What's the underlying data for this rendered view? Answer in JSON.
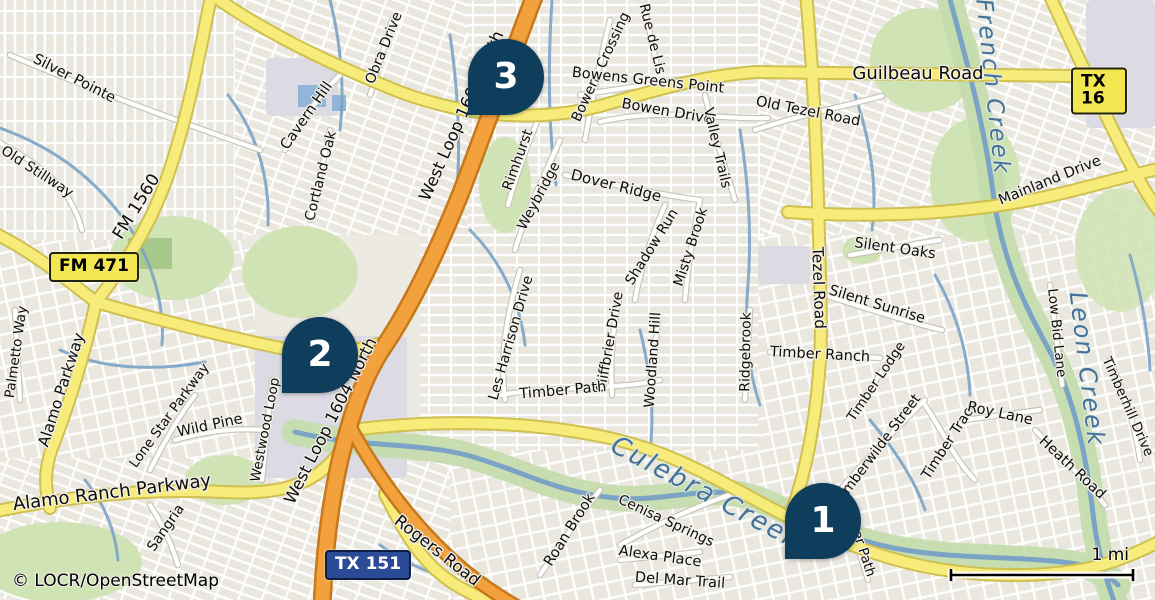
{
  "attribution": "© LOCR/OpenStreetMap",
  "scale": {
    "label": "1 mi"
  },
  "colors": {
    "marker": "#0f3e5d",
    "marker_text": "#ffffff",
    "water_label": "#44719c",
    "badge_yellow": "#f3e751",
    "badge_navy": "#2b4b96",
    "highway_orange": "#f2a13c",
    "road_yellow": "#f7ec7a",
    "creek_blue": "#7ba3c6",
    "park_green": "#cfe3b4"
  },
  "markers": [
    {
      "number": "1",
      "x": 823,
      "y": 521
    },
    {
      "number": "2",
      "x": 320,
      "y": 355
    },
    {
      "number": "3",
      "x": 506,
      "y": 77
    }
  ],
  "badges": [
    {
      "text": "FM 471",
      "x": 94,
      "y": 267,
      "style": "yellow"
    },
    {
      "text": "TX 151",
      "x": 368,
      "y": 565,
      "style": "navy"
    },
    {
      "text": "TX 16",
      "x": 1099,
      "y": 91,
      "style": "yellow"
    }
  ],
  "labels": [
    {
      "text": "Silver Pointe",
      "x": 74,
      "y": 79,
      "rot": 27,
      "size": 14.5
    },
    {
      "text": "Old Stillway",
      "x": 37,
      "y": 172,
      "rot": 33,
      "size": 14
    },
    {
      "text": "FM 1560",
      "x": 137,
      "y": 207,
      "rot": -58,
      "size": 17
    },
    {
      "text": "Palmetto Way",
      "x": 17,
      "y": 352,
      "rot": -82,
      "size": 13.5
    },
    {
      "text": "Alamo Parkway",
      "x": 62,
      "y": 390,
      "rot": -72,
      "size": 15.5
    },
    {
      "text": "Lone Star Parkway",
      "x": 170,
      "y": 416,
      "rot": -54,
      "size": 13.5
    },
    {
      "text": "Wild Pine",
      "x": 210,
      "y": 426,
      "rot": -12,
      "size": 14.5
    },
    {
      "text": "Alamo Ranch Parkway",
      "x": 112,
      "y": 493,
      "rot": -7,
      "size": 18
    },
    {
      "text": "Sangria",
      "x": 166,
      "y": 528,
      "rot": -55,
      "size": 14
    },
    {
      "text": "Westwood Loop",
      "x": 266,
      "y": 430,
      "rot": -79,
      "size": 13.5
    },
    {
      "text": "West Loop 1604 North",
      "x": 331,
      "y": 421,
      "rot": -63,
      "size": 16.5
    },
    {
      "text": "West Loop 1604 North",
      "x": 462,
      "y": 116,
      "rot": -66,
      "size": 16.5
    },
    {
      "text": "Rogers Road",
      "x": 437,
      "y": 551,
      "rot": 38,
      "size": 16.5
    },
    {
      "text": "Cavern Hill",
      "x": 307,
      "y": 116,
      "rot": -55,
      "size": 14.5
    },
    {
      "text": "Obra Drive",
      "x": 384,
      "y": 48,
      "rot": -68,
      "size": 14
    },
    {
      "text": "Cortland Oak",
      "x": 321,
      "y": 176,
      "rot": -76,
      "size": 14
    },
    {
      "text": "Rimhurst",
      "x": 518,
      "y": 160,
      "rot": -70,
      "size": 14
    },
    {
      "text": "Weybridge",
      "x": 539,
      "y": 196,
      "rot": -62,
      "size": 14
    },
    {
      "text": "Dover Ridge",
      "x": 616,
      "y": 186,
      "rot": 14,
      "size": 15
    },
    {
      "text": "Bowens Crossing",
      "x": 601,
      "y": 67,
      "rot": -65,
      "size": 14
    },
    {
      "text": "Rue de Lis",
      "x": 652,
      "y": 39,
      "rot": 76,
      "size": 14
    },
    {
      "text": "Bowens Greens Point",
      "x": 648,
      "y": 81,
      "rot": 6,
      "size": 14.5
    },
    {
      "text": "Bowen Drive",
      "x": 667,
      "y": 112,
      "rot": 10,
      "size": 14.5
    },
    {
      "text": "Valley Trails",
      "x": 717,
      "y": 148,
      "rot": 77,
      "size": 14
    },
    {
      "text": "Old Tezel Road",
      "x": 808,
      "y": 112,
      "rot": 11,
      "size": 14.5
    },
    {
      "text": "Guilbeau Road",
      "x": 918,
      "y": 74,
      "rot": 0,
      "size": 18
    },
    {
      "text": "Mainland Drive",
      "x": 1050,
      "y": 181,
      "rot": -22,
      "size": 14.5
    },
    {
      "text": "French Creek",
      "x": 992,
      "y": 87,
      "rot": 84,
      "size": 23,
      "kind": "water"
    },
    {
      "text": "Silent Oaks",
      "x": 895,
      "y": 249,
      "rot": 8,
      "size": 14.5
    },
    {
      "text": "Silent Sunrise",
      "x": 877,
      "y": 305,
      "rot": 17,
      "size": 14.5
    },
    {
      "text": "Tezel Road",
      "x": 818,
      "y": 288,
      "rot": 88,
      "size": 15.5
    },
    {
      "text": "Timber Ranch",
      "x": 820,
      "y": 355,
      "rot": 3,
      "size": 14.5
    },
    {
      "text": "Timber Lodge",
      "x": 877,
      "y": 382,
      "rot": -56,
      "size": 13.5
    },
    {
      "text": "Low Bid Lane",
      "x": 1056,
      "y": 333,
      "rot": 84,
      "size": 13.5
    },
    {
      "text": "Leon Creek",
      "x": 1087,
      "y": 369,
      "rot": 83,
      "size": 24,
      "kind": "water"
    },
    {
      "text": "Timberhill Drive",
      "x": 1127,
      "y": 407,
      "rot": 66,
      "size": 13.5
    },
    {
      "text": "Misty Brook",
      "x": 691,
      "y": 247,
      "rot": -72,
      "size": 14
    },
    {
      "text": "Shadow Run",
      "x": 652,
      "y": 247,
      "rot": -58,
      "size": 14
    },
    {
      "text": "Cliffbrier Drive",
      "x": 610,
      "y": 342,
      "rot": -80,
      "size": 14
    },
    {
      "text": "Woodland Hill",
      "x": 653,
      "y": 360,
      "rot": -86,
      "size": 14
    },
    {
      "text": "Ridgebrook",
      "x": 746,
      "y": 352,
      "rot": -89,
      "size": 14
    },
    {
      "text": "Les Harrison Drive",
      "x": 511,
      "y": 338,
      "rot": -74,
      "size": 14
    },
    {
      "text": "Timber Path",
      "x": 563,
      "y": 391,
      "rot": -5,
      "size": 14.5
    },
    {
      "text": "Timber Path",
      "x": 858,
      "y": 538,
      "rot": 72,
      "size": 13.5
    },
    {
      "text": "Timberwilde Street",
      "x": 878,
      "y": 449,
      "rot": -53,
      "size": 14
    },
    {
      "text": "Timber Trace",
      "x": 950,
      "y": 440,
      "rot": -57,
      "size": 14
    },
    {
      "text": "Roy Lane",
      "x": 1000,
      "y": 414,
      "rot": 12,
      "size": 14.5
    },
    {
      "text": "Heath Road",
      "x": 1072,
      "y": 468,
      "rot": 43,
      "size": 14.5
    },
    {
      "text": "Roan Brook",
      "x": 570,
      "y": 530,
      "rot": -58,
      "size": 14.5
    },
    {
      "text": "Cenisa Springs",
      "x": 666,
      "y": 521,
      "rot": 25,
      "size": 14
    },
    {
      "text": "Alexa Place",
      "x": 660,
      "y": 557,
      "rot": 8,
      "size": 14.5
    },
    {
      "text": "Del Mar Trail",
      "x": 680,
      "y": 581,
      "rot": 4,
      "size": 14.5
    },
    {
      "text": "Culebra Creek",
      "x": 706,
      "y": 493,
      "rot": 28,
      "size": 26,
      "kind": "water"
    }
  ]
}
